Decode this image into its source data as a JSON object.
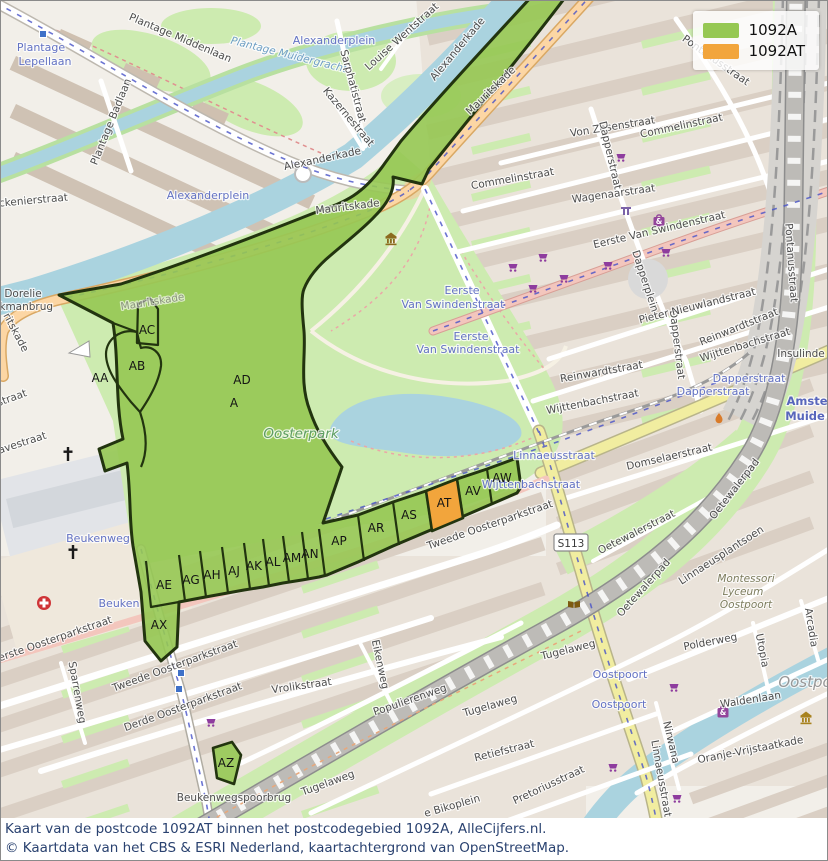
{
  "legend": {
    "items": [
      {
        "label": "1092A",
        "color": "#96c853"
      },
      {
        "label": "1092AT",
        "color": "#f2a53c"
      }
    ]
  },
  "caption": {
    "line1": "Kaart van de postcode 1092AT binnen het postcodegebied 1092A, AlleCijfers.nl.",
    "line2": "© Kaartdata van het CBS & ESRI Nederland, kaartachtergrond van OpenStreetMap."
  },
  "colors": {
    "area_green": "#96c853",
    "area_orange": "#f2a53c",
    "area_outline": "#22340f",
    "water": "#aad3df",
    "park": "#cdebb0",
    "road_primary": "#fcd6a4",
    "road_secondary": "#f1eda0",
    "caption_text": "#2a4270"
  },
  "map": {
    "road_shield": {
      "t": "S113",
      "x": 570,
      "y": 542
    },
    "region_labels": [
      {
        "t": "AA",
        "x": 99,
        "y": 381
      },
      {
        "t": "AB",
        "x": 136,
        "y": 369
      },
      {
        "t": "AC",
        "x": 146,
        "y": 333
      },
      {
        "t": "AD",
        "x": 241,
        "y": 383
      },
      {
        "t": "A",
        "x": 233,
        "y": 406
      },
      {
        "t": "AX",
        "x": 158,
        "y": 628
      },
      {
        "t": "AE",
        "x": 163,
        "y": 588
      },
      {
        "t": "AG",
        "x": 190,
        "y": 583
      },
      {
        "t": "AH",
        "x": 211,
        "y": 578
      },
      {
        "t": "AJ",
        "x": 233,
        "y": 574
      },
      {
        "t": "AK",
        "x": 253,
        "y": 569
      },
      {
        "t": "AL",
        "x": 272,
        "y": 565
      },
      {
        "t": "AM",
        "x": 291,
        "y": 561
      },
      {
        "t": "AN",
        "x": 309,
        "y": 557
      },
      {
        "t": "AP",
        "x": 338,
        "y": 544
      },
      {
        "t": "AR",
        "x": 375,
        "y": 531
      },
      {
        "t": "AS",
        "x": 408,
        "y": 518
      },
      {
        "t": "AT",
        "x": 443,
        "y": 506
      },
      {
        "t": "AV",
        "x": 472,
        "y": 494
      },
      {
        "t": "AW",
        "x": 501,
        "y": 481
      },
      {
        "t": "AZ",
        "x": 225,
        "y": 766
      }
    ],
    "street_labels": [
      {
        "t": "Plantage Middenlaan",
        "x": 178,
        "y": 40,
        "r": 23,
        "c": "street"
      },
      {
        "t": "Plantage",
        "x": 40,
        "y": 50,
        "r": 0,
        "c": "transit"
      },
      {
        "t": "Lepellaan",
        "x": 44,
        "y": 64,
        "r": 0,
        "c": "transit"
      },
      {
        "t": "Plantage Badlaan",
        "x": 113,
        "y": 122,
        "r": -68,
        "c": "street"
      },
      {
        "t": "Plantage Muidergracht",
        "x": 287,
        "y": 57,
        "r": 14,
        "c": "water"
      },
      {
        "t": "Sarphatistraat",
        "x": 349,
        "y": 86,
        "r": 75,
        "c": "street"
      },
      {
        "t": "Louise Wentstraat",
        "x": 403,
        "y": 38,
        "r": -42,
        "c": "street"
      },
      {
        "t": "Alexanderkade",
        "x": 459,
        "y": 50,
        "r": -50,
        "c": "street"
      },
      {
        "t": "Kazernestraat",
        "x": 345,
        "y": 118,
        "r": 50,
        "c": "street"
      },
      {
        "t": "Alexanderkade",
        "x": 322,
        "y": 161,
        "r": -12,
        "c": "street"
      },
      {
        "t": "Alexanderplein",
        "x": 333,
        "y": 43,
        "r": 0,
        "c": "transit"
      },
      {
        "t": "Alexanderplein",
        "x": 207,
        "y": 198,
        "r": 0,
        "c": "transit"
      },
      {
        "t": "Mauritskade",
        "x": 492,
        "y": 92,
        "r": -44,
        "c": "street"
      },
      {
        "t": "Mauritskade",
        "x": 347,
        "y": 209,
        "r": -7,
        "c": "street"
      },
      {
        "t": "Mauritskade",
        "x": 152,
        "y": 304,
        "r": -9,
        "c": "faded"
      },
      {
        "t": "ritskade",
        "x": 12,
        "y": 333,
        "r": 62,
        "c": "street"
      },
      {
        "t": "Dorelie",
        "x": 22,
        "y": 296,
        "r": 0,
        "c": "street"
      },
      {
        "t": "akmanbrug",
        "x": 22,
        "y": 309,
        "r": 0,
        "c": "street"
      },
      {
        "t": "alckenierstraat",
        "x": 28,
        "y": 203,
        "r": -5,
        "c": "street"
      },
      {
        "t": "straat",
        "x": 12,
        "y": 400,
        "r": -20,
        "c": "street"
      },
      {
        "t": "haavestraat",
        "x": 16,
        "y": 447,
        "r": -18,
        "c": "street"
      },
      {
        "t": "Von Zesenstraat",
        "x": 612,
        "y": 129,
        "r": -9,
        "c": "street"
      },
      {
        "t": "Commelinstraat",
        "x": 681,
        "y": 128,
        "r": -12,
        "c": "street"
      },
      {
        "t": "Commelinstraat",
        "x": 512,
        "y": 181,
        "r": -10,
        "c": "street"
      },
      {
        "t": "Wagenaarstraat",
        "x": 613,
        "y": 196,
        "r": -8,
        "c": "street"
      },
      {
        "t": "Pontanusstraat",
        "x": 713,
        "y": 62,
        "r": 35,
        "c": "street"
      },
      {
        "t": "Pontanusstraat",
        "x": 787,
        "y": 262,
        "r": 86,
        "c": "street"
      },
      {
        "t": "Eerste Van Swindenstraat",
        "x": 659,
        "y": 232,
        "r": -13,
        "c": "street"
      },
      {
        "t": "Eerste",
        "x": 461,
        "y": 293,
        "r": 0,
        "c": "transit"
      },
      {
        "t": "Van Swindenstraat",
        "x": 452,
        "y": 307,
        "r": 0,
        "c": "transit"
      },
      {
        "t": "Eerste",
        "x": 470,
        "y": 339,
        "r": 0,
        "c": "transit"
      },
      {
        "t": "Van Swindenstraat",
        "x": 467,
        "y": 352,
        "r": 0,
        "c": "transit"
      },
      {
        "t": "Dapperstraat",
        "x": 606,
        "y": 155,
        "r": 77,
        "c": "street"
      },
      {
        "t": "Dapperplein",
        "x": 641,
        "y": 281,
        "r": 72,
        "c": "street"
      },
      {
        "t": "Dapperstraat",
        "x": 673,
        "y": 344,
        "r": 83,
        "c": "street"
      },
      {
        "t": "Dapperstraat",
        "x": 748,
        "y": 381,
        "r": 0,
        "c": "transit"
      },
      {
        "t": "Dapperstraat",
        "x": 712,
        "y": 394,
        "r": 0,
        "c": "transit"
      },
      {
        "t": "Pieter Nieuwlandstraat",
        "x": 697,
        "y": 308,
        "r": -14,
        "c": "street"
      },
      {
        "t": "Reinwardtstraat",
        "x": 601,
        "y": 374,
        "r": -10,
        "c": "street"
      },
      {
        "t": "Reinwardtstraat",
        "x": 739,
        "y": 329,
        "r": -22,
        "c": "street"
      },
      {
        "t": "Wijttenbachstraat",
        "x": 592,
        "y": 404,
        "r": -11,
        "c": "street"
      },
      {
        "t": "Wijttenbachstraat",
        "x": 745,
        "y": 347,
        "r": -17,
        "c": "street"
      },
      {
        "t": "Wijttenbachstraat",
        "x": 530,
        "y": 487,
        "r": 0,
        "c": "transit"
      },
      {
        "t": "Linnaeusstraat",
        "x": 553,
        "y": 458,
        "r": 0,
        "c": "transit"
      },
      {
        "t": "Insulinde",
        "x": 800,
        "y": 356,
        "r": 0,
        "c": "street"
      },
      {
        "t": "Amste",
        "x": 806,
        "y": 404,
        "r": 0,
        "c": "station"
      },
      {
        "t": "Muide",
        "x": 804,
        "y": 419,
        "r": 0,
        "c": "station"
      },
      {
        "t": "Domselaerstraat",
        "x": 669,
        "y": 459,
        "r": -13,
        "c": "street"
      },
      {
        "t": "Oetewalerstraat",
        "x": 637,
        "y": 534,
        "r": -27,
        "c": "street"
      },
      {
        "t": "Oetewalerpad",
        "x": 645,
        "y": 589,
        "r": -48,
        "c": "street"
      },
      {
        "t": "Oetewalerpad",
        "x": 736,
        "y": 490,
        "r": -52,
        "c": "street"
      },
      {
        "t": "Linnaeusplantsoen",
        "x": 722,
        "y": 557,
        "r": -33,
        "c": "street"
      },
      {
        "t": "Montessori",
        "x": 745,
        "y": 581,
        "r": 0,
        "c": "poi"
      },
      {
        "t": "Lyceum",
        "x": 742,
        "y": 594,
        "r": 0,
        "c": "poi"
      },
      {
        "t": "Oostpoort",
        "x": 745,
        "y": 607,
        "r": 0,
        "c": "poi"
      },
      {
        "t": "Tweede Oosterparkstraat",
        "x": 490,
        "y": 527,
        "r": -19,
        "c": "street"
      },
      {
        "t": "Tweede Oosterparkstraat",
        "x": 175,
        "y": 668,
        "r": -20,
        "c": "street"
      },
      {
        "t": "Eerste Oosterparkstraat",
        "x": 52,
        "y": 642,
        "r": -19,
        "c": "street"
      },
      {
        "t": "Derde Oosterparkstraat",
        "x": 183,
        "y": 709,
        "r": -20,
        "c": "street"
      },
      {
        "t": "Sparrenweg",
        "x": 73,
        "y": 692,
        "r": 80,
        "c": "street"
      },
      {
        "t": "Beukenweg",
        "x": 97,
        "y": 541,
        "r": 0,
        "c": "transit"
      },
      {
        "t": "Beuken",
        "x": 118,
        "y": 606,
        "r": 0,
        "c": "transit"
      },
      {
        "t": "Vrolikstraat",
        "x": 301,
        "y": 688,
        "r": -8,
        "c": "street"
      },
      {
        "t": "Eikenweg",
        "x": 376,
        "y": 664,
        "r": 78,
        "c": "street"
      },
      {
        "t": "Populierenweg",
        "x": 410,
        "y": 702,
        "r": -19,
        "c": "street"
      },
      {
        "t": "Tugelaweg",
        "x": 490,
        "y": 708,
        "r": -16,
        "c": "street"
      },
      {
        "t": "Tugelaweg",
        "x": 568,
        "y": 652,
        "r": -14,
        "c": "street"
      },
      {
        "t": "Tugelaweg",
        "x": 328,
        "y": 785,
        "r": -20,
        "c": "street"
      },
      {
        "t": "Retiefstraat",
        "x": 504,
        "y": 753,
        "r": -14,
        "c": "street"
      },
      {
        "t": "Pretoriusstraat",
        "x": 549,
        "y": 787,
        "r": -25,
        "c": "street"
      },
      {
        "t": "e Bikoplein",
        "x": 452,
        "y": 808,
        "r": -16,
        "c": "street"
      },
      {
        "t": "Beukenwegspoorbrug",
        "x": 233,
        "y": 800,
        "r": 0,
        "c": "street"
      },
      {
        "t": "Oostpoort",
        "x": 619,
        "y": 677,
        "r": 0,
        "c": "transit"
      },
      {
        "t": "Oostpoort",
        "x": 618,
        "y": 707,
        "r": 0,
        "c": "transit"
      },
      {
        "t": "Polderweg",
        "x": 710,
        "y": 644,
        "r": -11,
        "c": "street"
      },
      {
        "t": "Waldenlaan",
        "x": 750,
        "y": 702,
        "r": -9,
        "c": "street"
      },
      {
        "t": "Utopia",
        "x": 758,
        "y": 650,
        "r": 79,
        "c": "street"
      },
      {
        "t": "Arcadia",
        "x": 807,
        "y": 627,
        "r": 81,
        "c": "street"
      },
      {
        "t": "Nirwana",
        "x": 667,
        "y": 742,
        "r": 77,
        "c": "street"
      },
      {
        "t": "Oranje-Vrijstaatkade",
        "x": 750,
        "y": 752,
        "r": -11,
        "c": "street"
      },
      {
        "t": "Linnaeusstraat",
        "x": 657,
        "y": 778,
        "r": 80,
        "c": "street"
      },
      {
        "t": "Oostpo",
        "x": 804,
        "y": 686,
        "r": 0,
        "c": "place"
      },
      {
        "t": "Oosterpark",
        "x": 300,
        "y": 437,
        "r": 0,
        "c": "park"
      }
    ],
    "icons": [
      {
        "n": "shopping-cart-icon",
        "x": 512,
        "y": 267
      },
      {
        "n": "shopping-cart-icon",
        "x": 542,
        "y": 257
      },
      {
        "n": "shopping-cart-icon",
        "x": 607,
        "y": 265
      },
      {
        "n": "shopping-cart-icon",
        "x": 563,
        "y": 278
      },
      {
        "n": "shopping-cart-icon",
        "x": 532,
        "y": 288
      },
      {
        "n": "shopping-cart-icon",
        "x": 665,
        "y": 252
      },
      {
        "n": "shopping-cart-icon",
        "x": 620,
        "y": 157
      },
      {
        "n": "shopping-cart-icon",
        "x": 673,
        "y": 687
      },
      {
        "n": "shopping-cart-icon",
        "x": 612,
        "y": 767
      },
      {
        "n": "shopping-cart-icon",
        "x": 676,
        "y": 798
      },
      {
        "n": "shopping-cart-icon",
        "x": 210,
        "y": 722
      },
      {
        "n": "hospital-icon",
        "x": 43,
        "y": 602
      },
      {
        "n": "church-cross-icon",
        "x": 67,
        "y": 453
      },
      {
        "n": "church-cross-icon",
        "x": 72,
        "y": 551
      },
      {
        "n": "library-book-icon",
        "x": 573,
        "y": 603
      },
      {
        "n": "museum-icon",
        "x": 390,
        "y": 238
      },
      {
        "n": "temple-icon",
        "x": 805,
        "y": 717
      },
      {
        "n": "shop-bag-icon",
        "x": 658,
        "y": 219
      },
      {
        "n": "shop-bag-icon",
        "x": 722,
        "y": 710
      },
      {
        "n": "monument-icon",
        "x": 625,
        "y": 210
      },
      {
        "n": "flame-icon",
        "x": 718,
        "y": 417
      },
      {
        "n": "transit-stop-icon",
        "x": 180,
        "y": 672
      },
      {
        "n": "transit-stop-icon",
        "x": 178,
        "y": 688
      },
      {
        "n": "transit-stop-icon",
        "x": 42,
        "y": 33
      }
    ]
  }
}
